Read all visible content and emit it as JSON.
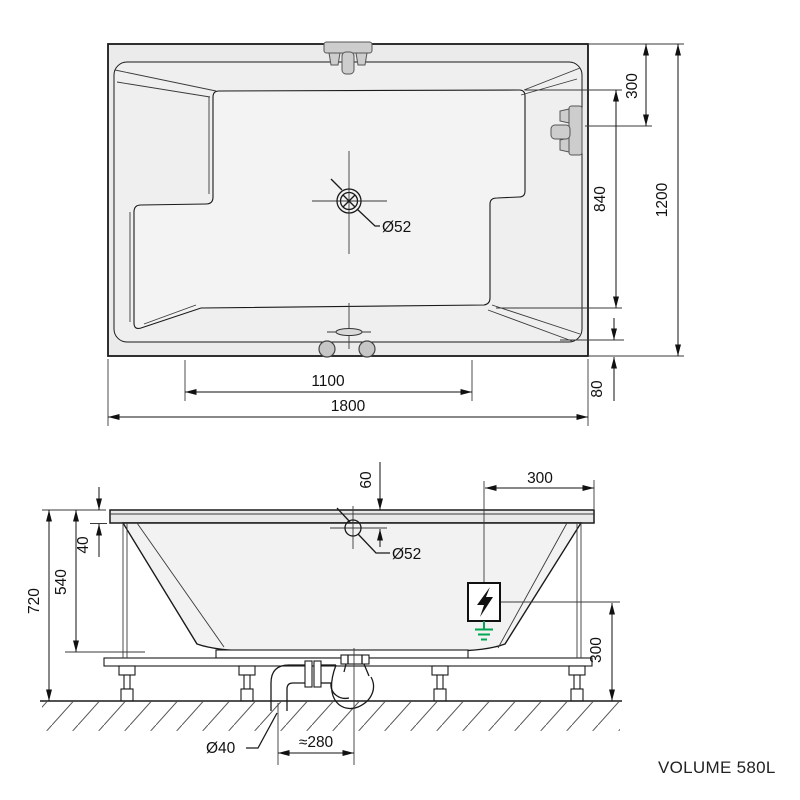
{
  "drawing": {
    "volume_label": "VOLUME 580L",
    "colors": {
      "line": "#1a1a1a",
      "tub_fill": "#ebebeb",
      "ground_green": "#00a651"
    },
    "top_view": {
      "drain_diameter": "Ø52",
      "dim_fixture_from_edge": "300",
      "dim_inner_width": "840",
      "dim_overall_width": "1200",
      "dim_edge_offset": "80",
      "dim_inner_length": "1100",
      "dim_overall_length": "1800"
    },
    "side_view": {
      "dim_overflow_from_rim": "60",
      "dim_electric_from_edge": "300",
      "dim_rim_thickness": "40",
      "dim_depth": "540",
      "dim_overall_height": "720",
      "dim_electric_height": "300",
      "overflow_diameter": "Ø52",
      "waste_diameter": "Ø40",
      "dim_waste_offset": "≈280"
    }
  }
}
